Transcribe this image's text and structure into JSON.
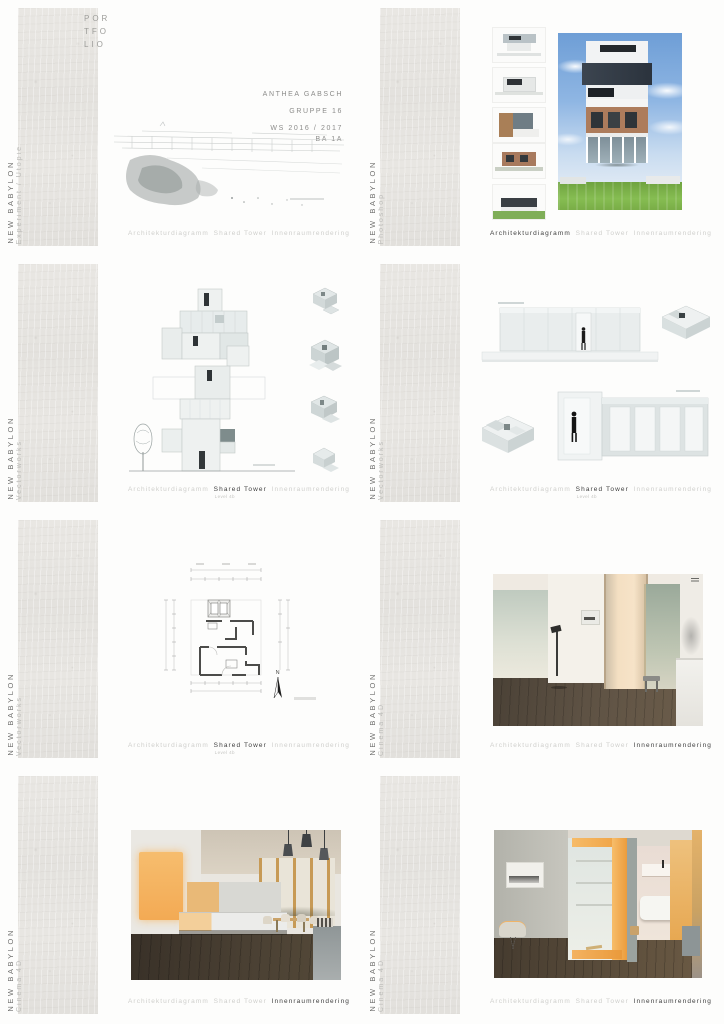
{
  "brand": {
    "line1": "POR",
    "line2": "TFO",
    "line3": "LIO"
  },
  "cover": {
    "author": "ANTHEA GABSCH",
    "group": "GRUPPE 16",
    "semester": "WS 2016 / 2017",
    "course": "BA 1A"
  },
  "sidebar": {
    "project": "NEW BABYLON"
  },
  "tabs": {
    "diagram": "Architekturdiagramm",
    "tower": "Shared Tower",
    "tower_sub": "Level 4b",
    "render": "Innenraumrendering"
  },
  "panels": [
    {
      "tool": "Experiment / Utopie"
    },
    {
      "tool": "Photoshop"
    },
    {
      "tool": "Vectorworks"
    },
    {
      "tool": "Vectorworks"
    },
    {
      "tool": "Vectorworks"
    },
    {
      "tool": "Cinema 4D"
    },
    {
      "tool": "Cinema 4D"
    },
    {
      "tool": "Cinema 4D"
    }
  ],
  "floorplan": {
    "north": "N"
  },
  "colors": {
    "accent_orange": "#f2b468",
    "concrete": "#e6e4e0",
    "ink": "#3e3e3e",
    "muted": "#cfcfcc",
    "sky_blue": "#6e9ed6",
    "lawn_green": "#6fa33f"
  }
}
